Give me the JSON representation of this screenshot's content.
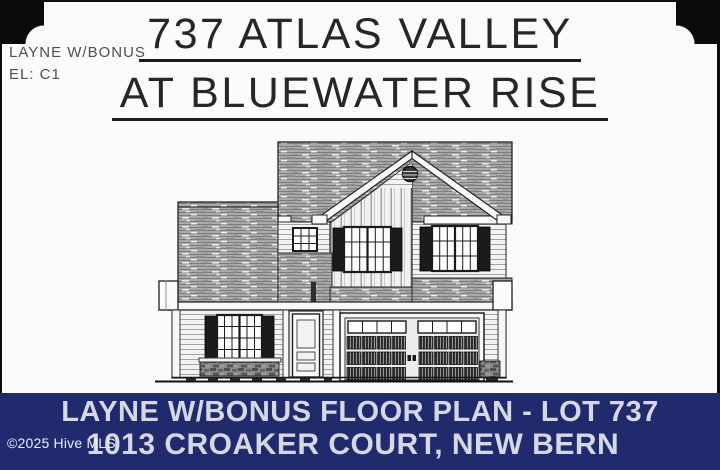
{
  "plan_label": {
    "line1": "LAYNE W/BONUS",
    "line2": "EL: C1"
  },
  "title": {
    "line1": "737 ATLAS VALLEY",
    "line2": "AT BLUEWATER RISE"
  },
  "banner": {
    "line1": "LAYNE W/BONUS FLOOR PLAN - LOT 737",
    "line2": "1013 CROAKER COURT, NEW BERN",
    "bg_color": "#202a6d",
    "text_color": "#d6d8e6"
  },
  "watermark": {
    "text": "©2025 Hive MLS",
    "color": "#eff0f5"
  },
  "drawing": {
    "type": "architectural-front-elevation",
    "features": [
      "main-roof-shingles",
      "left-roof-shingles",
      "center-gable",
      "gable-vent",
      "board-and-batten-gable-siding",
      "lap-siding",
      "shuttered-window-gable",
      "shuttered-window-right",
      "shuttered-window-first-floor",
      "small-square-window",
      "front-door",
      "two-car-garage-door",
      "brick-skirt",
      "foundation-ground-line"
    ]
  }
}
